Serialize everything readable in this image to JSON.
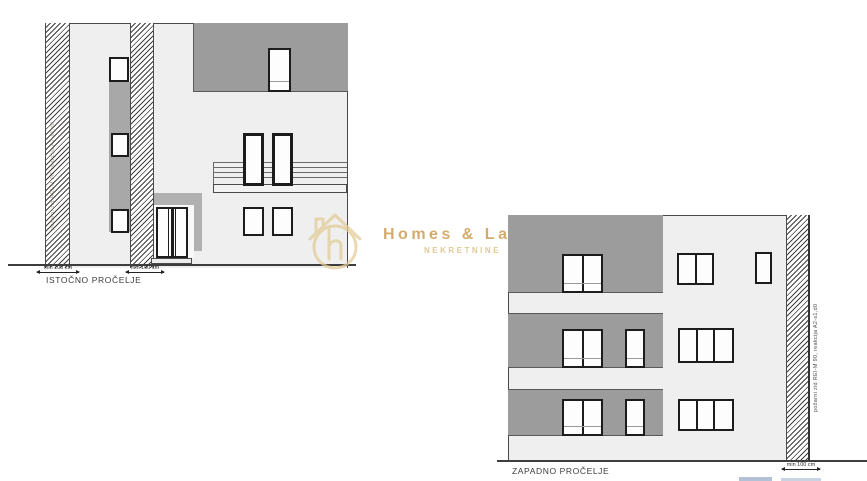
{
  "east": {
    "label": "ISTOČNO PROČELJE",
    "dim_left": "min 100 cm",
    "dim_right": "min 100 cm",
    "firewall_note": "požarni zid REI-M 90, reakcija A2-s1,d0"
  },
  "west": {
    "label": "ZAPADNO PROČELJE",
    "dim_right": "min 100 cm",
    "firewall_note": "požarni zid REI-M 90, reakcija A2-s1,d0"
  },
  "watermark": {
    "brand": "Homes & Lands.",
    "subtitle": "NEKRETNINE"
  },
  "colors": {
    "wall_light": "#efefef",
    "wall_gray": "#9c9c9c",
    "frame_dark": "#1c1c1c",
    "ground": "#3d3d3d",
    "watermark_gold": "#cfa254"
  }
}
